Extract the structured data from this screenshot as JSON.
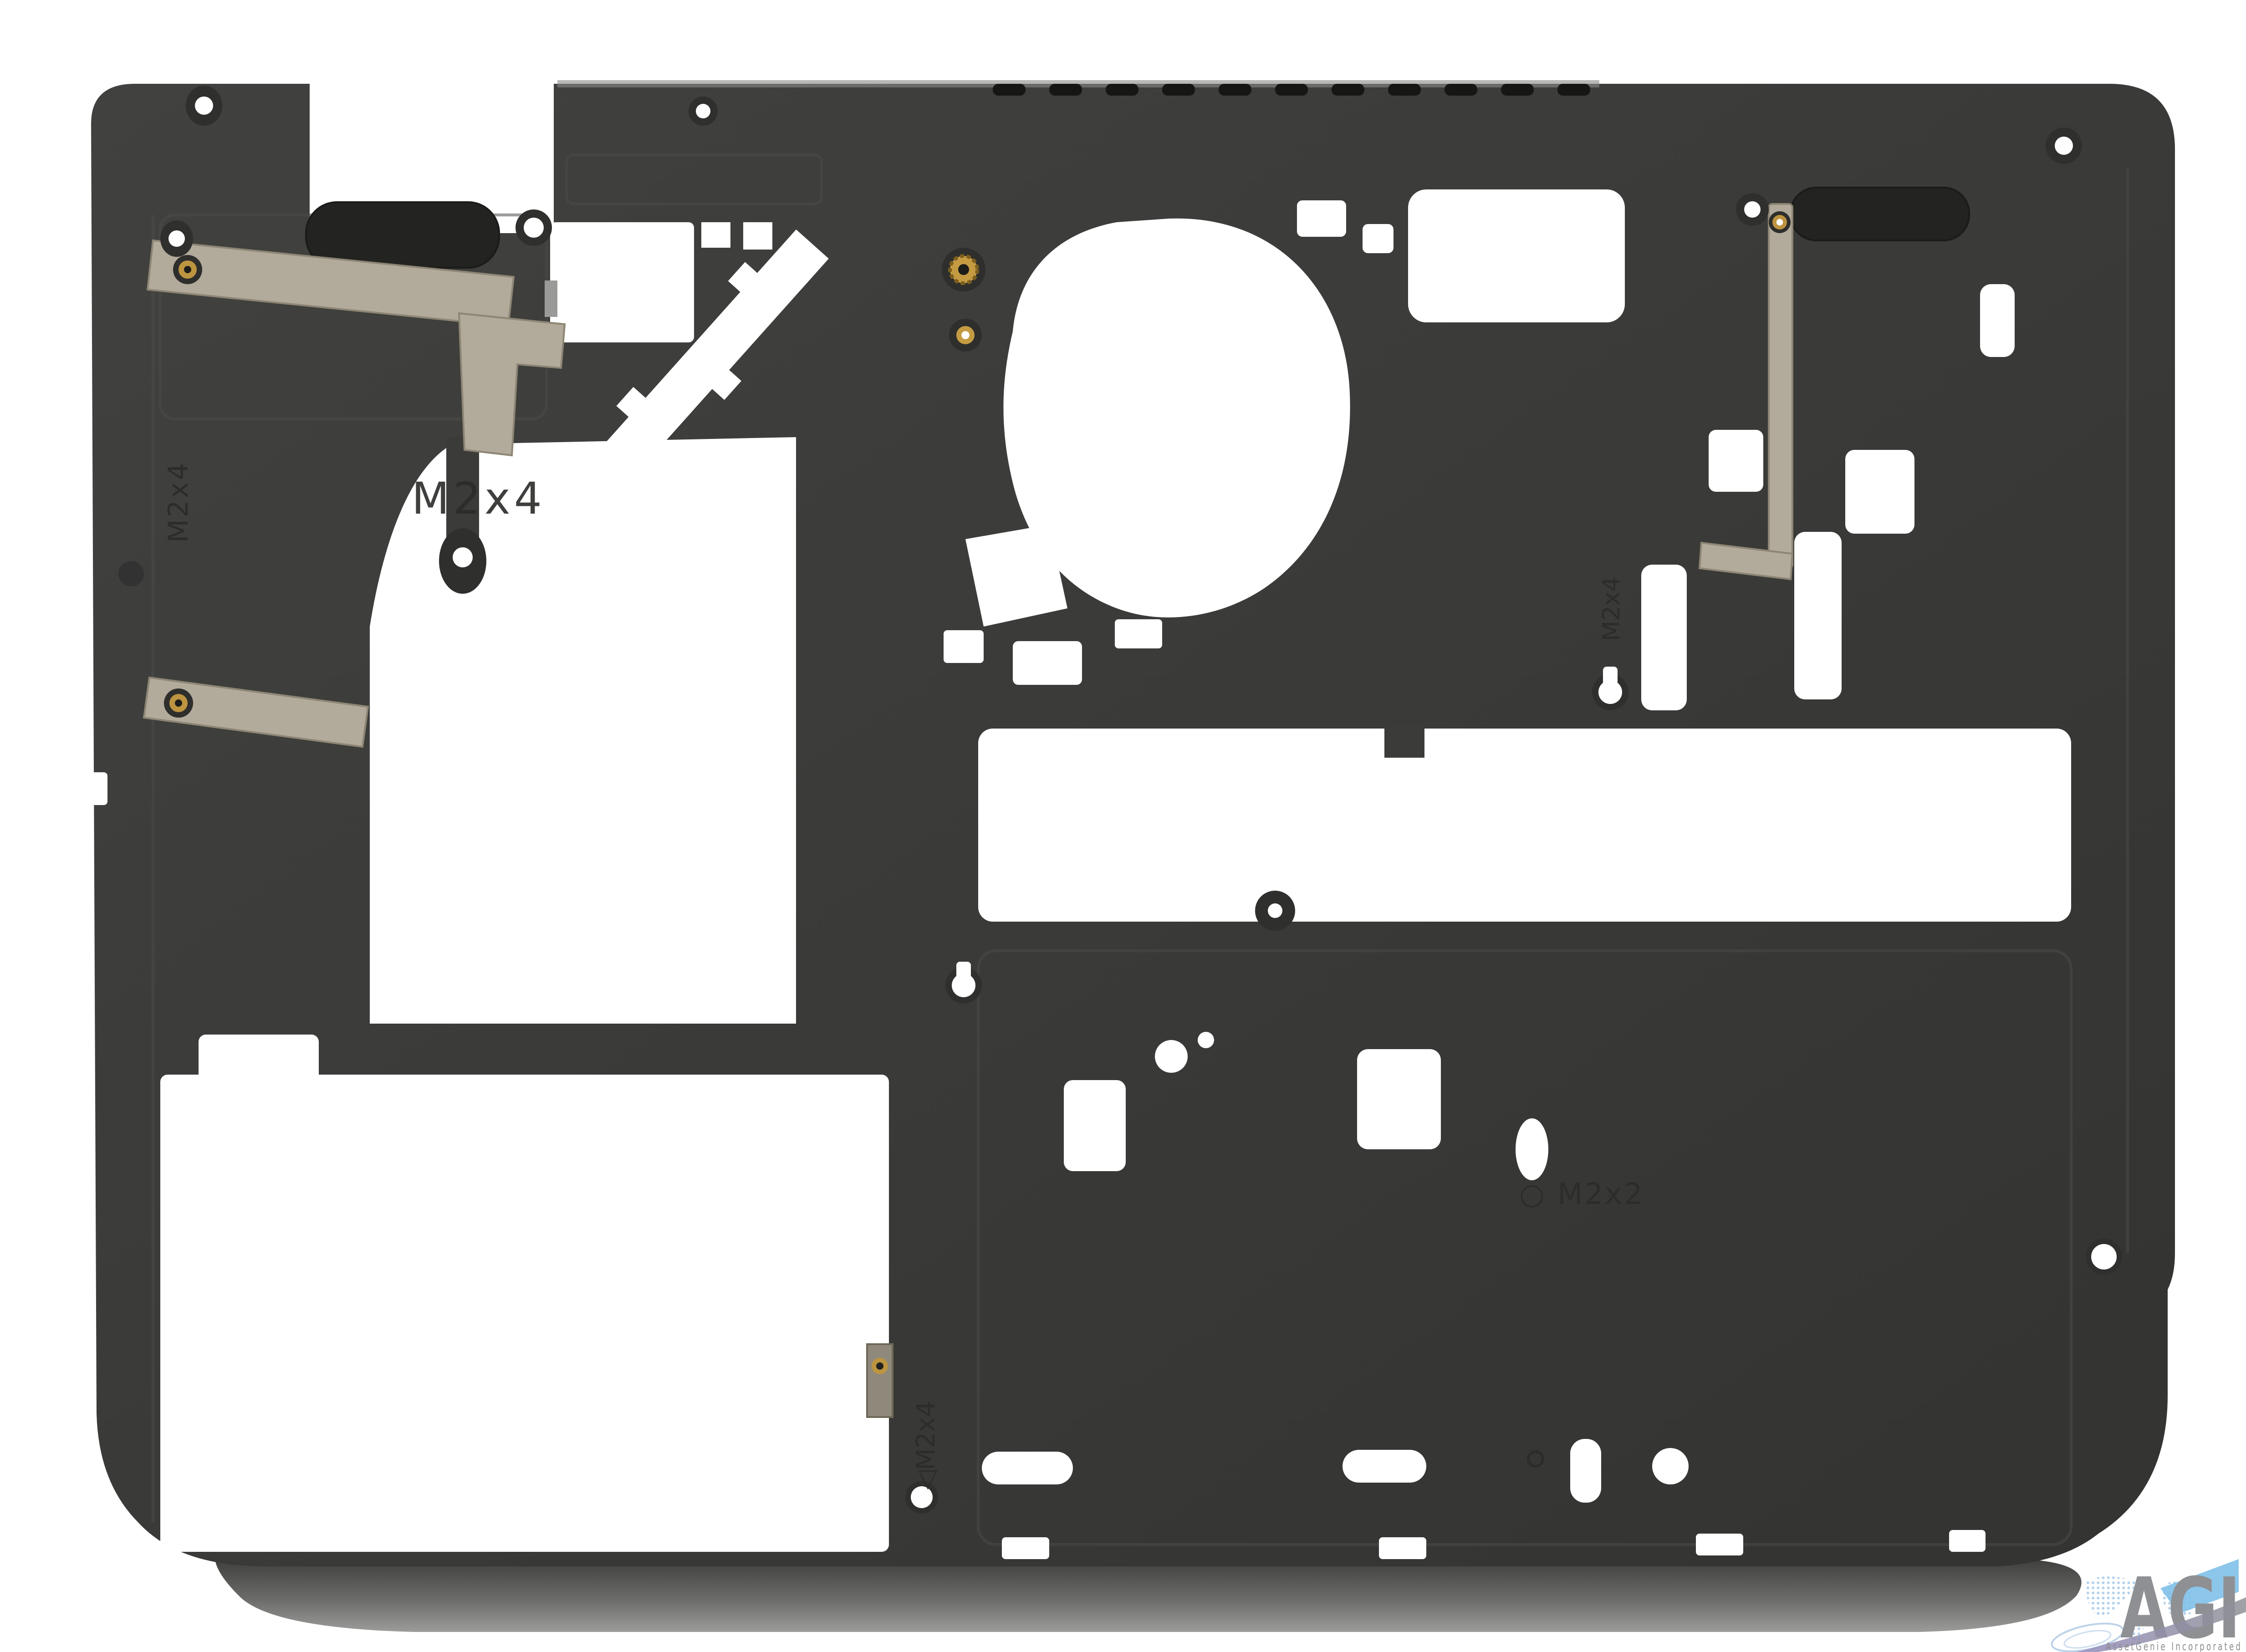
{
  "scene": {
    "type": "product-photo",
    "subject": "laptop bottom case interior, viewed from inside",
    "background_color": "#ffffff"
  },
  "part": {
    "case_color": "#3b3b39",
    "foot_color": "#232321",
    "antenna_strip_color": "#b2aa9a",
    "brass_color": "#bd9440",
    "embossed_labels": [
      {
        "id": "left-rim-vertical",
        "text": "M2x4"
      },
      {
        "id": "left-panel-horizontal",
        "text": "M2x4"
      },
      {
        "id": "right-mid-vertical",
        "text": "M2x4"
      },
      {
        "id": "bottom-center-vertical",
        "text": "◁M2x4"
      },
      {
        "id": "right-lower-horizontal",
        "text": "○ M2x2"
      }
    ]
  },
  "watermark": {
    "abbr": "AGI",
    "company": "AssetGenie Incorporated",
    "letters_color": "#8f9093",
    "accent_blue": "#7fc0e8",
    "map_blue": "#a9cdec",
    "swoosh_purple": "#968dbd"
  }
}
